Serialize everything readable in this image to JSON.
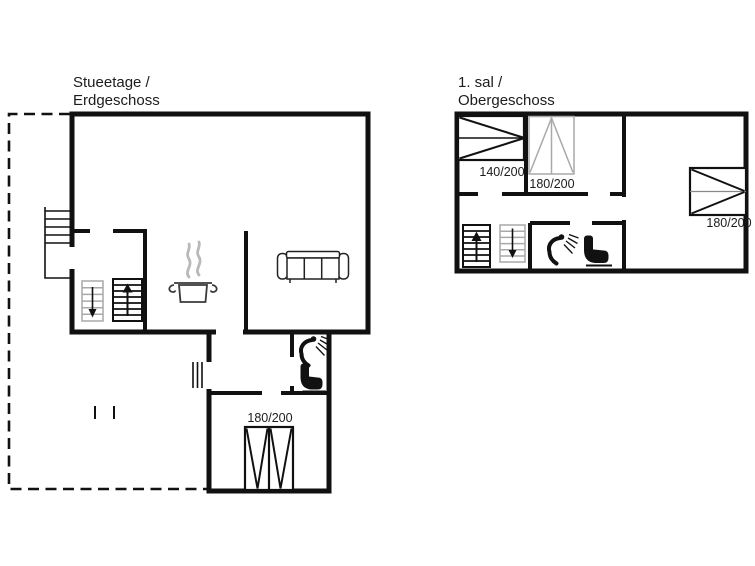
{
  "colors": {
    "wall": "#111111",
    "light_gray": "#a9a9a9",
    "steam_gray": "#b9b9b9",
    "background": "#ffffff",
    "text": "#1c1c1c"
  },
  "floors": {
    "ground": {
      "title_line1": "Stueetage /",
      "title_line2": "Erdgeschoss",
      "bed_label": "180/200"
    },
    "upper": {
      "title_line1": "1. sal /",
      "title_line2": "Obergeschoss",
      "bed_left_label": "140/200",
      "bed_center_label": "180/200",
      "bed_right_label": "180/200"
    }
  },
  "icons": {
    "stairs_up": "stairs-up-arrow",
    "stairs_down": "stairs-down-arrow",
    "shower": "shower-head-with-spray",
    "toilet": "toilet-side-view",
    "sofa": "three-seat-sofa-top-view",
    "cooking_pot": "steaming-pot",
    "double_bed": "double-bed-top-view",
    "single_bed": "bed-top-view",
    "entrance_steps": "exterior-steps",
    "terrace_door": "door-threshold-hatch"
  }
}
